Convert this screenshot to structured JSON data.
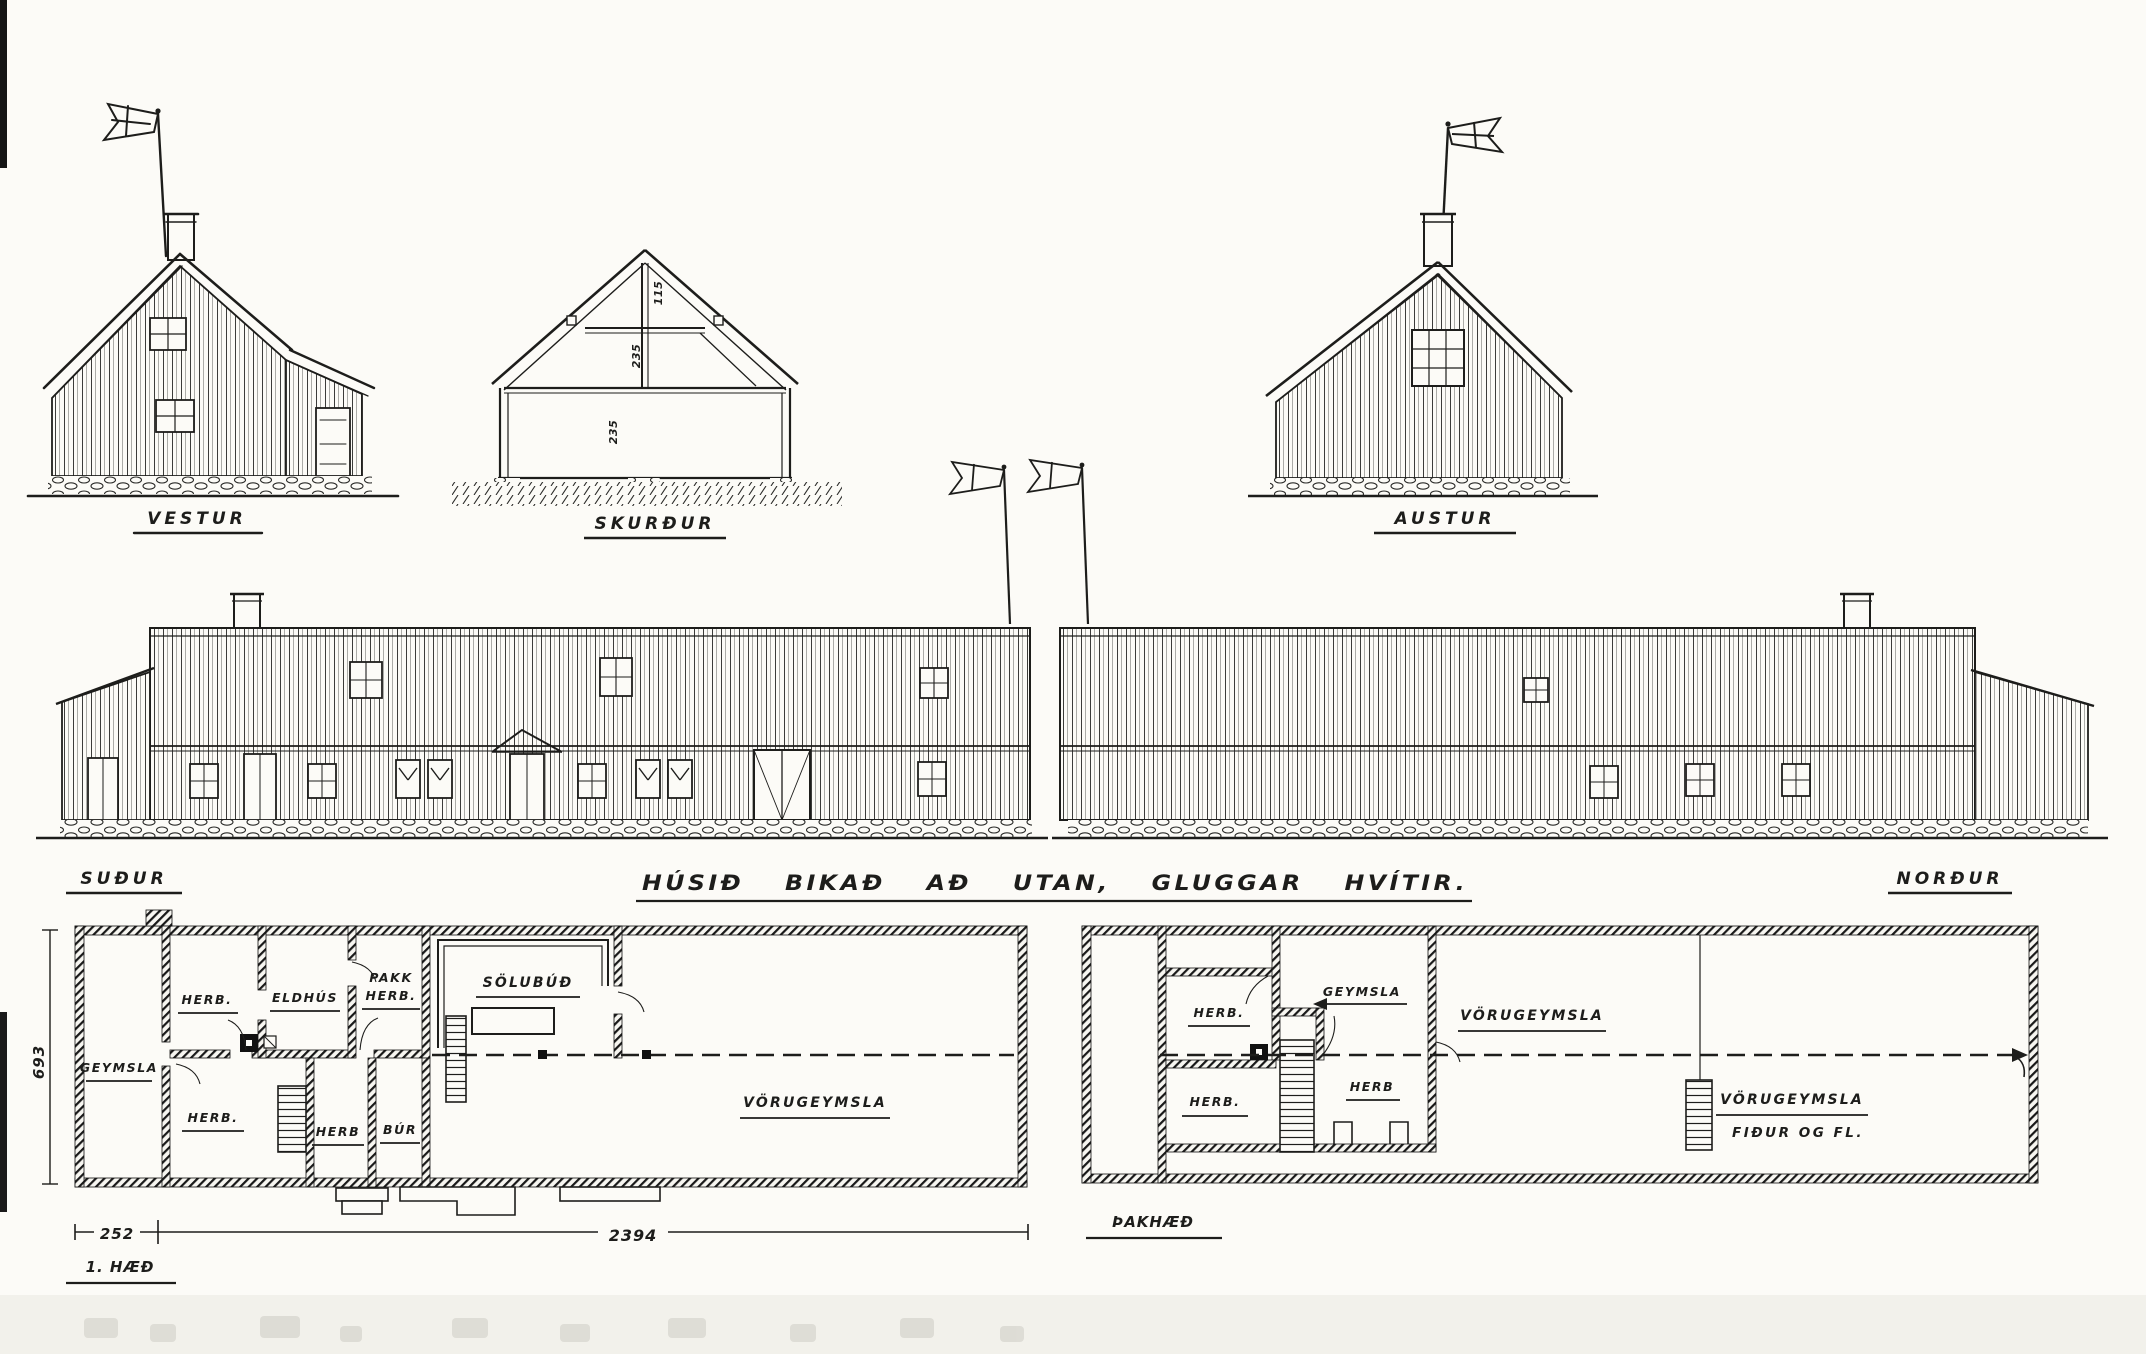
{
  "title_block": {
    "caption": "HÚSIÐ BIKAÐ AÐ UTAN, GLUGGAR HVÍTIR."
  },
  "elevations": {
    "west_label": "VESTUR",
    "section_label": "SKURÐUR",
    "east_label": "AUSTUR",
    "south_label": "SUÐUR",
    "north_label": "NORÐUR",
    "section_dims": {
      "ridge": "115",
      "loft": "235",
      "wall": "235"
    }
  },
  "ground_plan": {
    "floor_label": "1. HÆÐ",
    "rooms": {
      "geymsla": "GEYMSLA",
      "herb_nw": "HERB.",
      "eldhus": "ELDHÚS",
      "pakkherb_line1": "PAKK",
      "pakkherb_line2": "HERB.",
      "solubud": "SÖLUBÚÐ",
      "herb_sw": "HERB.",
      "herb_s": "HERB",
      "bur": "BÚR",
      "vorugeymsla": "VÖRUGEYMSLA"
    },
    "dimensions": {
      "depth": "693",
      "annex_width": "252",
      "length": "2394"
    }
  },
  "attic_plan": {
    "floor_label": "ÞAKHÆÐ",
    "rooms": {
      "herb_n": "HERB.",
      "geymsla": "GEYMSLA",
      "vorugeymsla_n": "VÖRUGEYMSLA",
      "herb_sw": "HERB.",
      "herb_s": "HERB",
      "vorugeymsla_s_line1": "VÖRUGEYMSLA",
      "vorugeymsla_s_line2": "FIÐUR OG FL."
    }
  }
}
